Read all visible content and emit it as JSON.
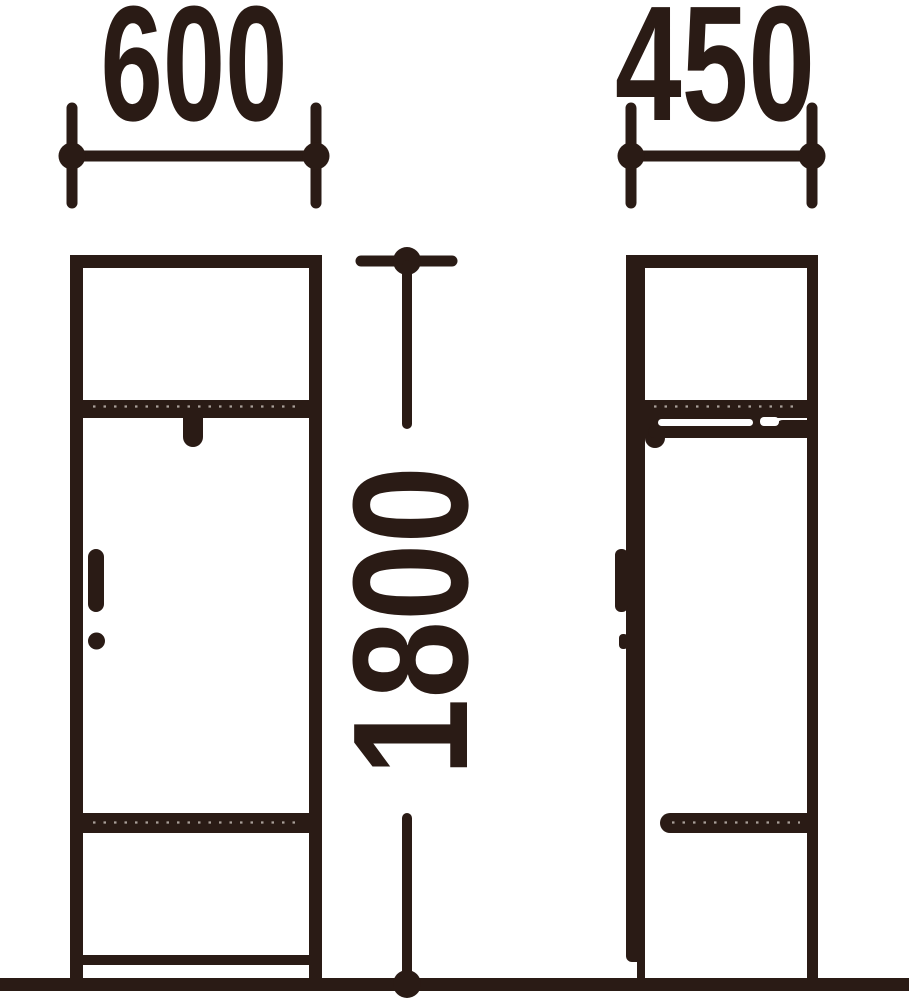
{
  "drawing": {
    "background": "#ffffff",
    "ink_color": "#2a1b15",
    "perforation_color": "#a99f99",
    "dimensions": {
      "front_width": "600",
      "side_depth": "450",
      "height": "1800"
    }
  }
}
